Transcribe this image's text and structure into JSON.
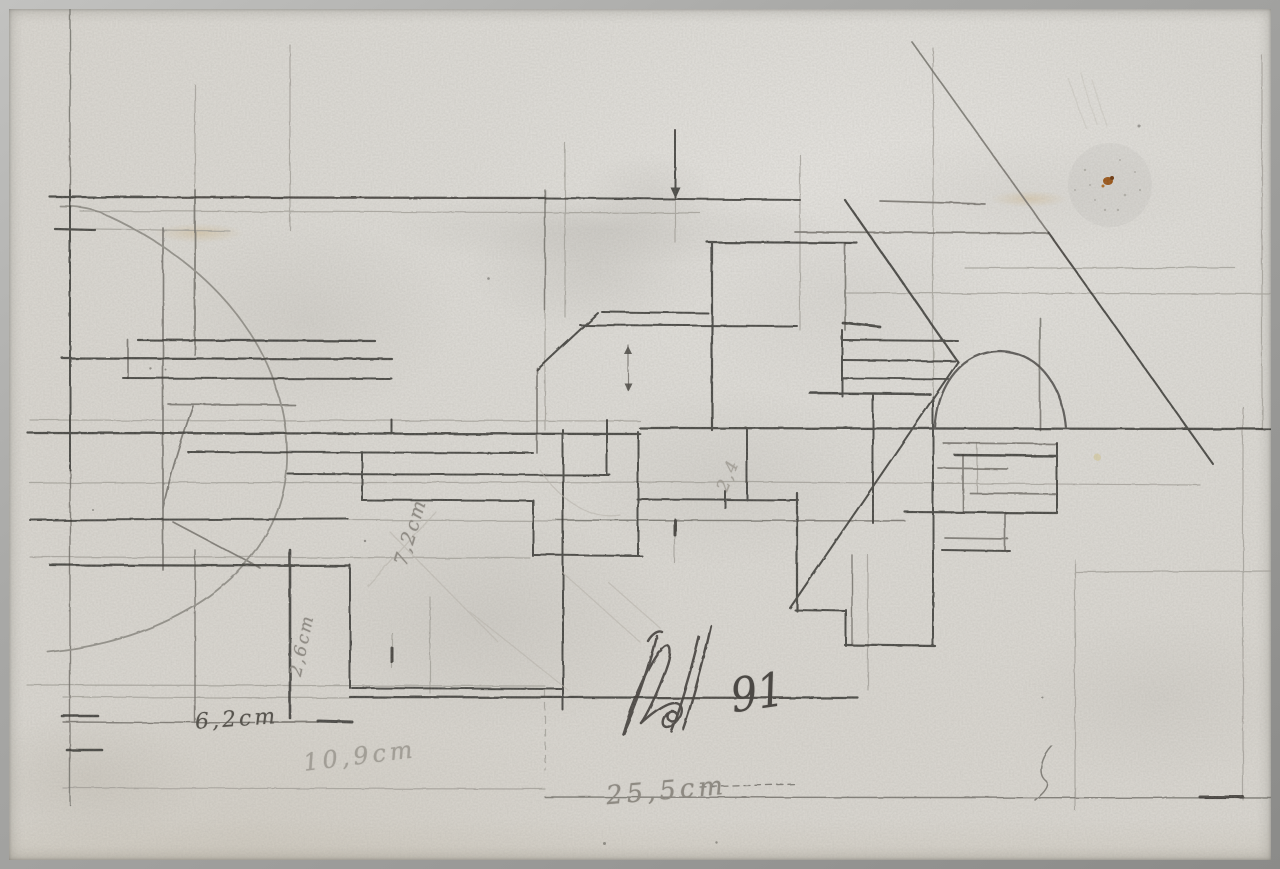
{
  "artwork_annotations": {
    "dim_6_2": "6,2cm",
    "dim_10_9": "10,9cm",
    "dim_25_5": "25,5cm",
    "dim_7_2": "7,2cm",
    "dim_2_6": "2,6cm",
    "dim_2_4": "2,4",
    "signature_year": "91"
  },
  "colors": {
    "paper": "#dcd9d3",
    "photo_frame": "#a3a3a1",
    "graphite_dark": "#363430",
    "graphite_medium": "#6f6c66",
    "graphite_faint": "#a29f98",
    "stain_rust": "#99500f"
  }
}
